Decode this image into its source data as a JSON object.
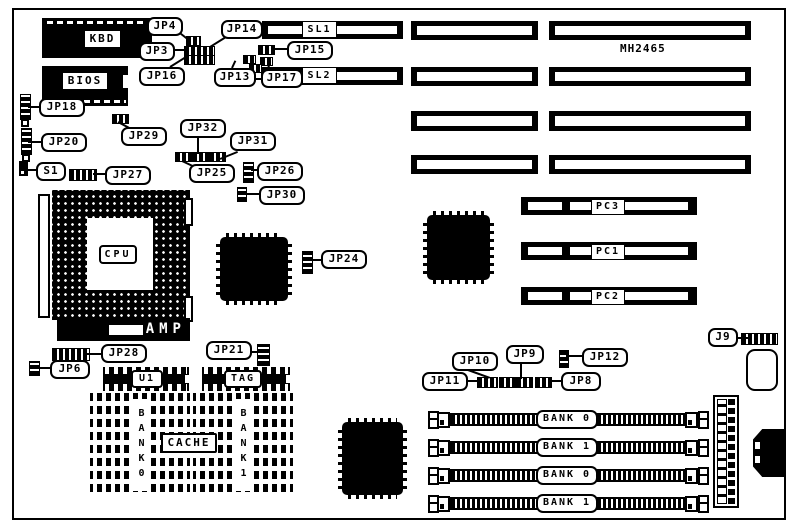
{
  "board": {
    "model": "MH2465"
  },
  "chips": {
    "kbd": "KBD",
    "bios": "BIOS",
    "cpu": "CPU",
    "amp": "AMP",
    "u1": "U1",
    "tag": "TAG"
  },
  "cache": {
    "title": "CACHE",
    "bank0": "BANK0",
    "bank1": "BANK1"
  },
  "slots": {
    "sl1": "SL1",
    "sl2": "SL2",
    "pc1": "PC1",
    "pc2": "PC2",
    "pc3": "PC3"
  },
  "simm_banks": [
    "BANK 0",
    "BANK 1",
    "BANK 0",
    "BANK 1"
  ],
  "connectors": {
    "j9": "J9",
    "s1": "S1"
  },
  "jumpers": {
    "jp3": "JP3",
    "jp4": "JP4",
    "jp6": "JP6",
    "jp8": "JP8",
    "jp9": "JP9",
    "jp10": "JP10",
    "jp11": "JP11",
    "jp12": "JP12",
    "jp13": "JP13",
    "jp14": "JP14",
    "jp15": "JP15",
    "jp16": "JP16",
    "jp17": "JP17",
    "jp18": "JP18",
    "jp20": "JP20",
    "jp21": "JP21",
    "jp24": "JP24",
    "jp25": "JP25",
    "jp26": "JP26",
    "jp27": "JP27",
    "jp28": "JP28",
    "jp29": "JP29",
    "jp30": "JP30",
    "jp31": "JP31",
    "jp32": "JP32"
  }
}
